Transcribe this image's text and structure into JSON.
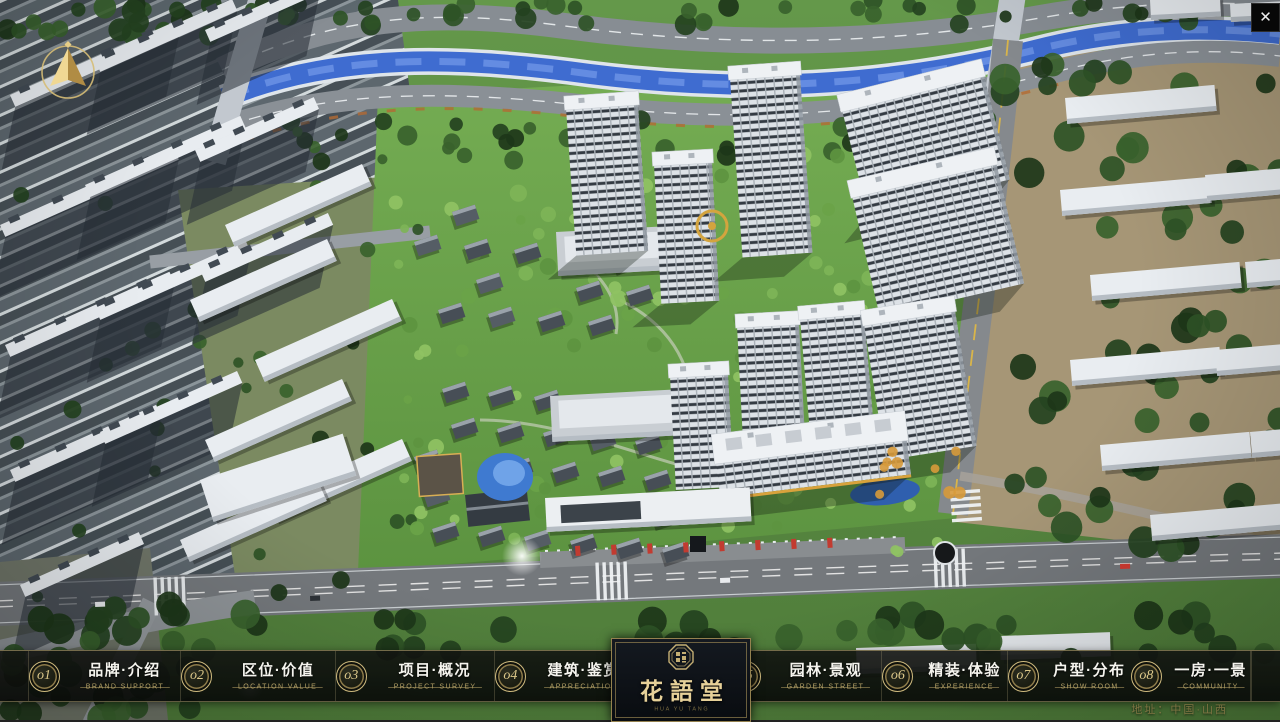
{
  "app": {
    "close_glyph": "✕"
  },
  "logo": {
    "title": "花語堂",
    "subtitle": "HUA YU TANG"
  },
  "nav": {
    "items": [
      {
        "num": "o1",
        "zh": "品牌·介绍",
        "en": "BRAND SUPPORT"
      },
      {
        "num": "o2",
        "zh": "区位·价值",
        "en": "LOCATION VALUE"
      },
      {
        "num": "o3",
        "zh": "项目·概况",
        "en": "PROJECT SURVEY"
      },
      {
        "num": "o4",
        "zh": "建筑·鉴赏",
        "en": "APPRECIATION"
      },
      {
        "num": "o5",
        "zh": "园林·景观",
        "en": "GARDEN STREET"
      },
      {
        "num": "o6",
        "zh": "精装·体验",
        "en": "EXPERIENCE"
      },
      {
        "num": "o7",
        "zh": "户型·分布",
        "en": "SHOW ROOM"
      },
      {
        "num": "o8",
        "zh": "一房·一景",
        "en": "COMMUNITY"
      }
    ]
  },
  "footer": {
    "address": "地址：中国·山西"
  },
  "colors": {
    "accent_gold": "#c9b478",
    "bar_bg": "#121411",
    "panel_bg": "#0b0e13",
    "text_white": "#f5f4ee",
    "en_tan": "#b3a066",
    "river_blue": "#3f6cd0",
    "site_green": "#6aa24c",
    "road_grey": "#74787c"
  }
}
